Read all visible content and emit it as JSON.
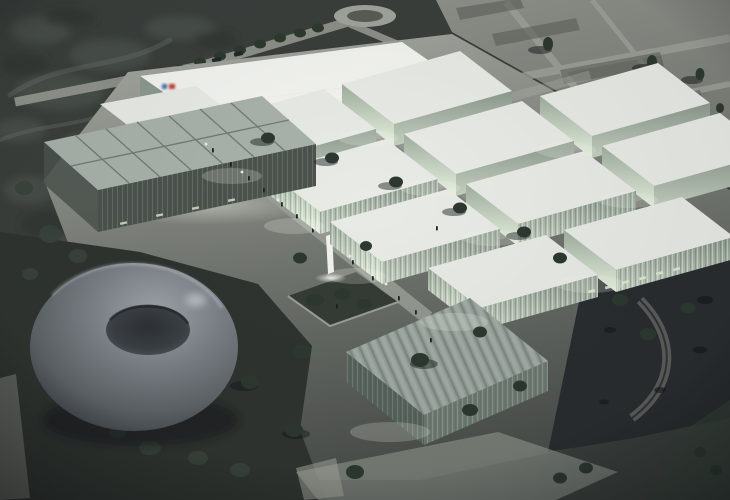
{
  "image": {
    "kind": "architectural-aerial-render",
    "setting": "dusk aerial view of a research campus with glowing glass pavilions",
    "elements": [
      "torus-pavilion",
      "white-box-laboratories",
      "rear-headquarters-building",
      "gridded-glass-roof-hall",
      "striped-roof-pavilion",
      "central-boulevard",
      "sunken-garden",
      "sculpture",
      "roundabout",
      "desert-site-roads",
      "scattered-trees",
      "tiny-pedestrians"
    ],
    "building_count": 14
  },
  "palette": {
    "terrain_base": "#3a3f3c",
    "rock_light": "#5a5f58",
    "rock_mid": "#30342f",
    "terr_top": "#8f928b",
    "terr_bot": "#747871",
    "road_light": "#a2a59d",
    "patch_dark": "#595d55",
    "plaza_top": "#a9ada5",
    "plaza_mid": "#71756f",
    "plaza_bot": "#4c504c",
    "avenue": "#9aa098",
    "street": "#b2b5ad",
    "ground_dark": "#2f3430",
    "night": "#292d2f",
    "roof_white": "#e9ebe6",
    "roof_bright": "#f4f5f1",
    "roof_glass": "#a9b2ab",
    "roof_textured": "#96a19a",
    "glass_top": "#9fae9f",
    "glass_bottom": "#e9f3e1",
    "side_top": "#8c9a8e",
    "side_bottom": "#c6d1c2",
    "facade_dark": "#4c534d",
    "textured_front": "#57645c",
    "textured_side": "#6f7c72",
    "tree": "#2d3930",
    "bush": "#39453c",
    "people": "#1d2126",
    "vehicle": "#23272c",
    "lamp": "#eef2e2",
    "glow": "#f2f6ea",
    "wall_light": "#e3ecd7",
    "curve_road": "#5f6361",
    "shadow": "#14171a",
    "torus1": "#a6abb1",
    "torus2": "#7f858b",
    "torus3": "#61666b",
    "torus4": "#404549",
    "hole1": "#2e3237",
    "hole2": "#3b4045",
    "hole3": "#565b61",
    "garden": "#353b35",
    "garden_edge": "#b9beb5",
    "sculpture": "#f2f3ee"
  },
  "logo": {
    "blue": "#3f6fae",
    "red": "#bf3b31"
  }
}
